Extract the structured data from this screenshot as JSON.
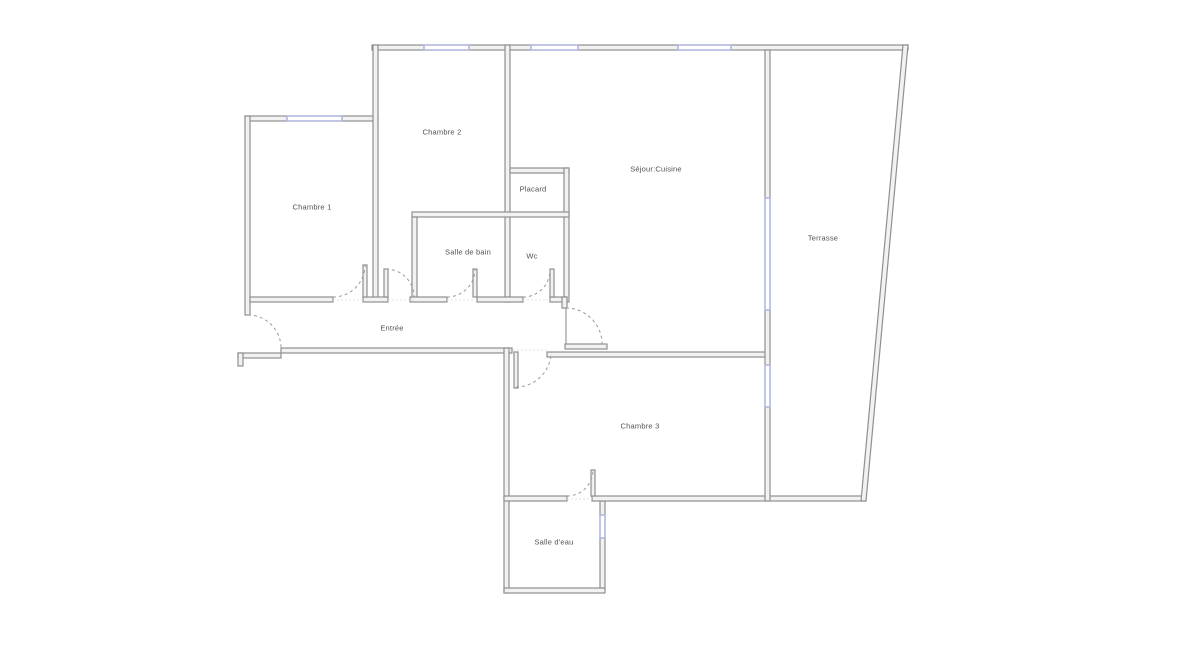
{
  "plan": {
    "type": "apartment-floor-plan",
    "background": "#ffffff"
  },
  "colors": {
    "wall_stroke": "#8f8f8f",
    "wall_fill": "#f2f2f2",
    "window": "#b3b8e0",
    "door_arc": "#9a9a9a",
    "label_text": "#4f4f4f"
  },
  "rooms": [
    {
      "id": "chambre-1",
      "label": "Chambre 1"
    },
    {
      "id": "chambre-2",
      "label": "Chambre 2"
    },
    {
      "id": "placard",
      "label": "Placard"
    },
    {
      "id": "salle-de-bain",
      "label": "Salle de bain"
    },
    {
      "id": "wc",
      "label": "Wc"
    },
    {
      "id": "entree",
      "label": "Entrée"
    },
    {
      "id": "sejour-cuisine",
      "label": "Séjour:Cuisine"
    },
    {
      "id": "terrasse",
      "label": "Terrasse"
    },
    {
      "id": "chambre-3",
      "label": "Chambre 3"
    },
    {
      "id": "salle-d-eau",
      "label": "Salle d'eau"
    }
  ]
}
